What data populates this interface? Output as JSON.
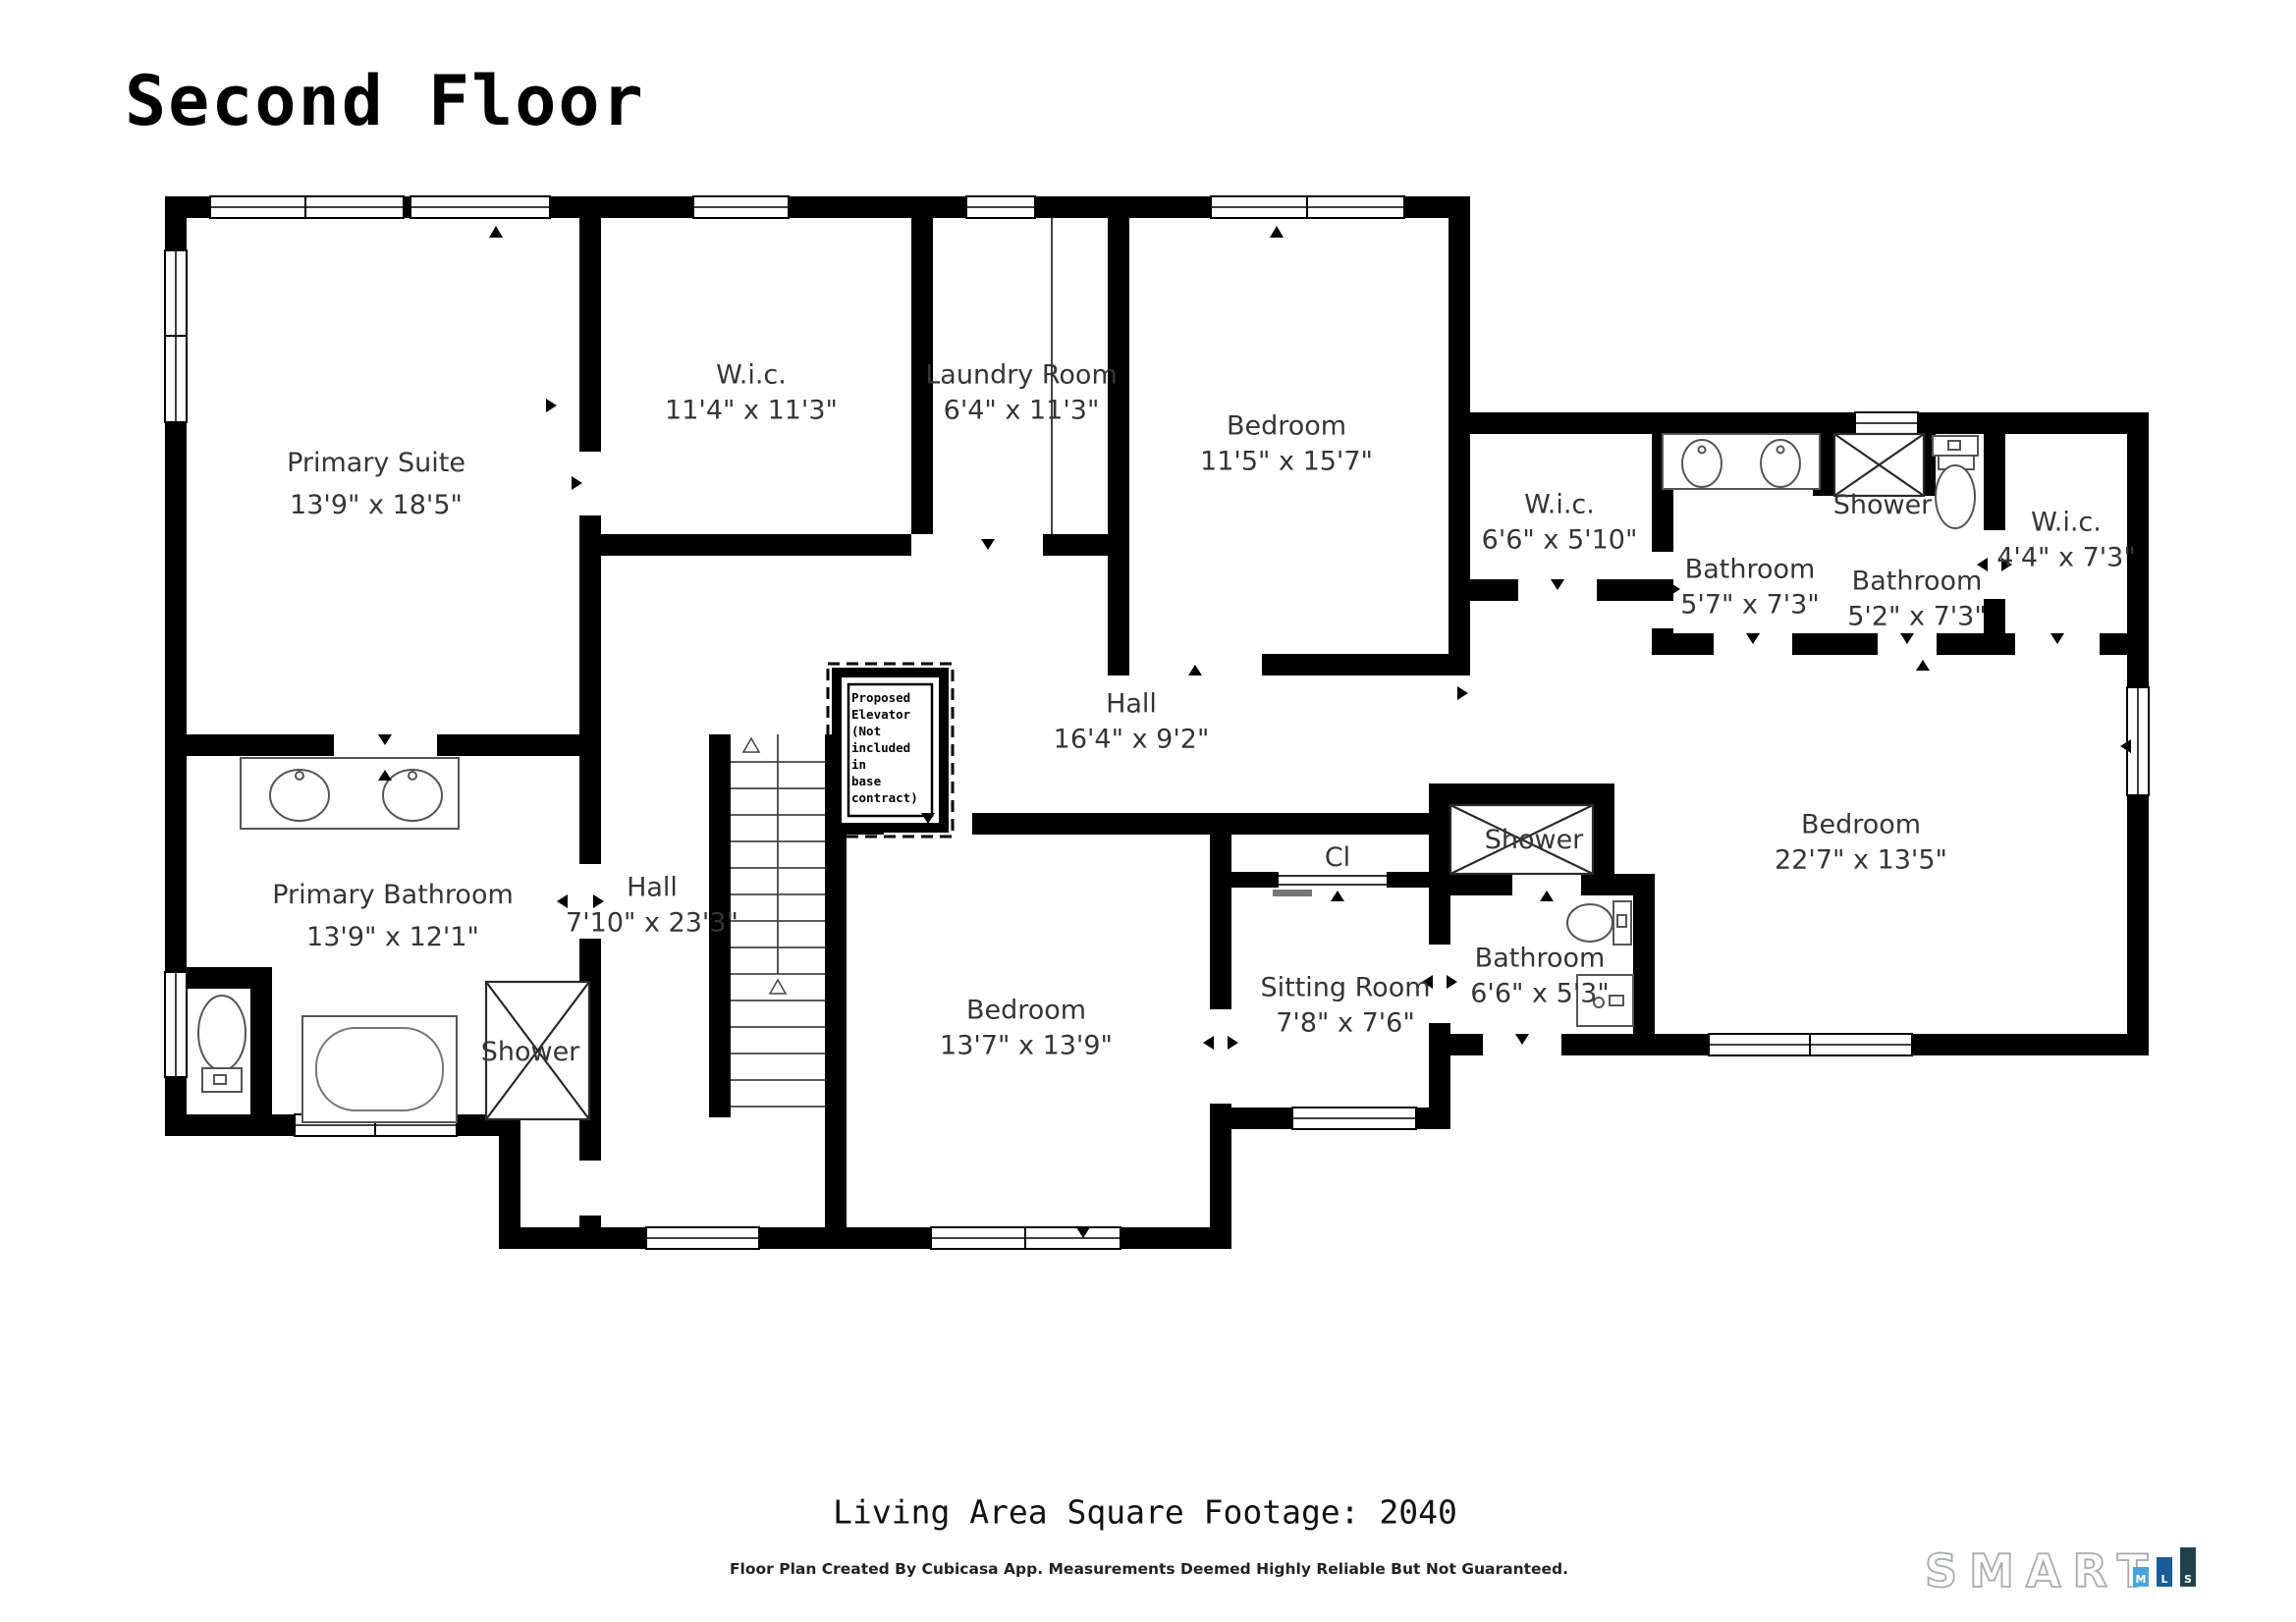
{
  "title": "Second Floor",
  "rooms": [
    {
      "name": "Primary Suite",
      "dims": "13'9\" x 18'5\""
    },
    {
      "name": "W.i.c.",
      "dims": "11'4\" x 11'3\""
    },
    {
      "name": "Laundry Room",
      "dims": "6'4\" x 11'3\""
    },
    {
      "name": "Bedroom",
      "dims": "11'5\" x 15'7\""
    },
    {
      "name": "W.i.c.",
      "dims": "6'6\" x 5'10\""
    },
    {
      "name": "Bathroom",
      "dims": "5'7\" x 7'3\""
    },
    {
      "name": "Shower",
      "dims": ""
    },
    {
      "name": "Bathroom",
      "dims": "5'2\" x 7'3\""
    },
    {
      "name": "W.i.c.",
      "dims": "4'4\" x 7'3\""
    },
    {
      "name": "Hall",
      "dims": "16'4\" x 9'2\""
    },
    {
      "name": "Hall",
      "dims": "7'10\" x 23'3\""
    },
    {
      "name": "Bedroom",
      "dims": "13'7\" x 13'9\""
    },
    {
      "name": "Cl",
      "dims": ""
    },
    {
      "name": "Shower",
      "dims": ""
    },
    {
      "name": "Sitting Room",
      "dims": "7'8\" x 7'6\""
    },
    {
      "name": "Bathroom",
      "dims": "6'6\" x 5'3\""
    },
    {
      "name": "Bedroom",
      "dims": "22'7\" x 13'5\""
    },
    {
      "name": "Primary Bathroom",
      "dims": "13'9\" x 12'1\""
    },
    {
      "name": "Shower",
      "dims": ""
    }
  ],
  "elevator_note": {
    "lines": [
      "Proposed",
      "Elevator",
      "(Not",
      "included in",
      "base",
      "contract)"
    ]
  },
  "footer": {
    "line1": "Living Area Square Footage: 2040",
    "line2": "Floor Plan Created By Cubicasa App. Measurements Deemed Highly Reliable But Not Guaranteed."
  },
  "logo": {
    "word": "SMART",
    "word_color": "#a7abae",
    "bars": [
      {
        "letter": "M",
        "color": "#4aa3dc"
      },
      {
        "letter": "L",
        "color": "#1b5c9b"
      },
      {
        "letter": "S",
        "color": "#23404e"
      }
    ]
  }
}
